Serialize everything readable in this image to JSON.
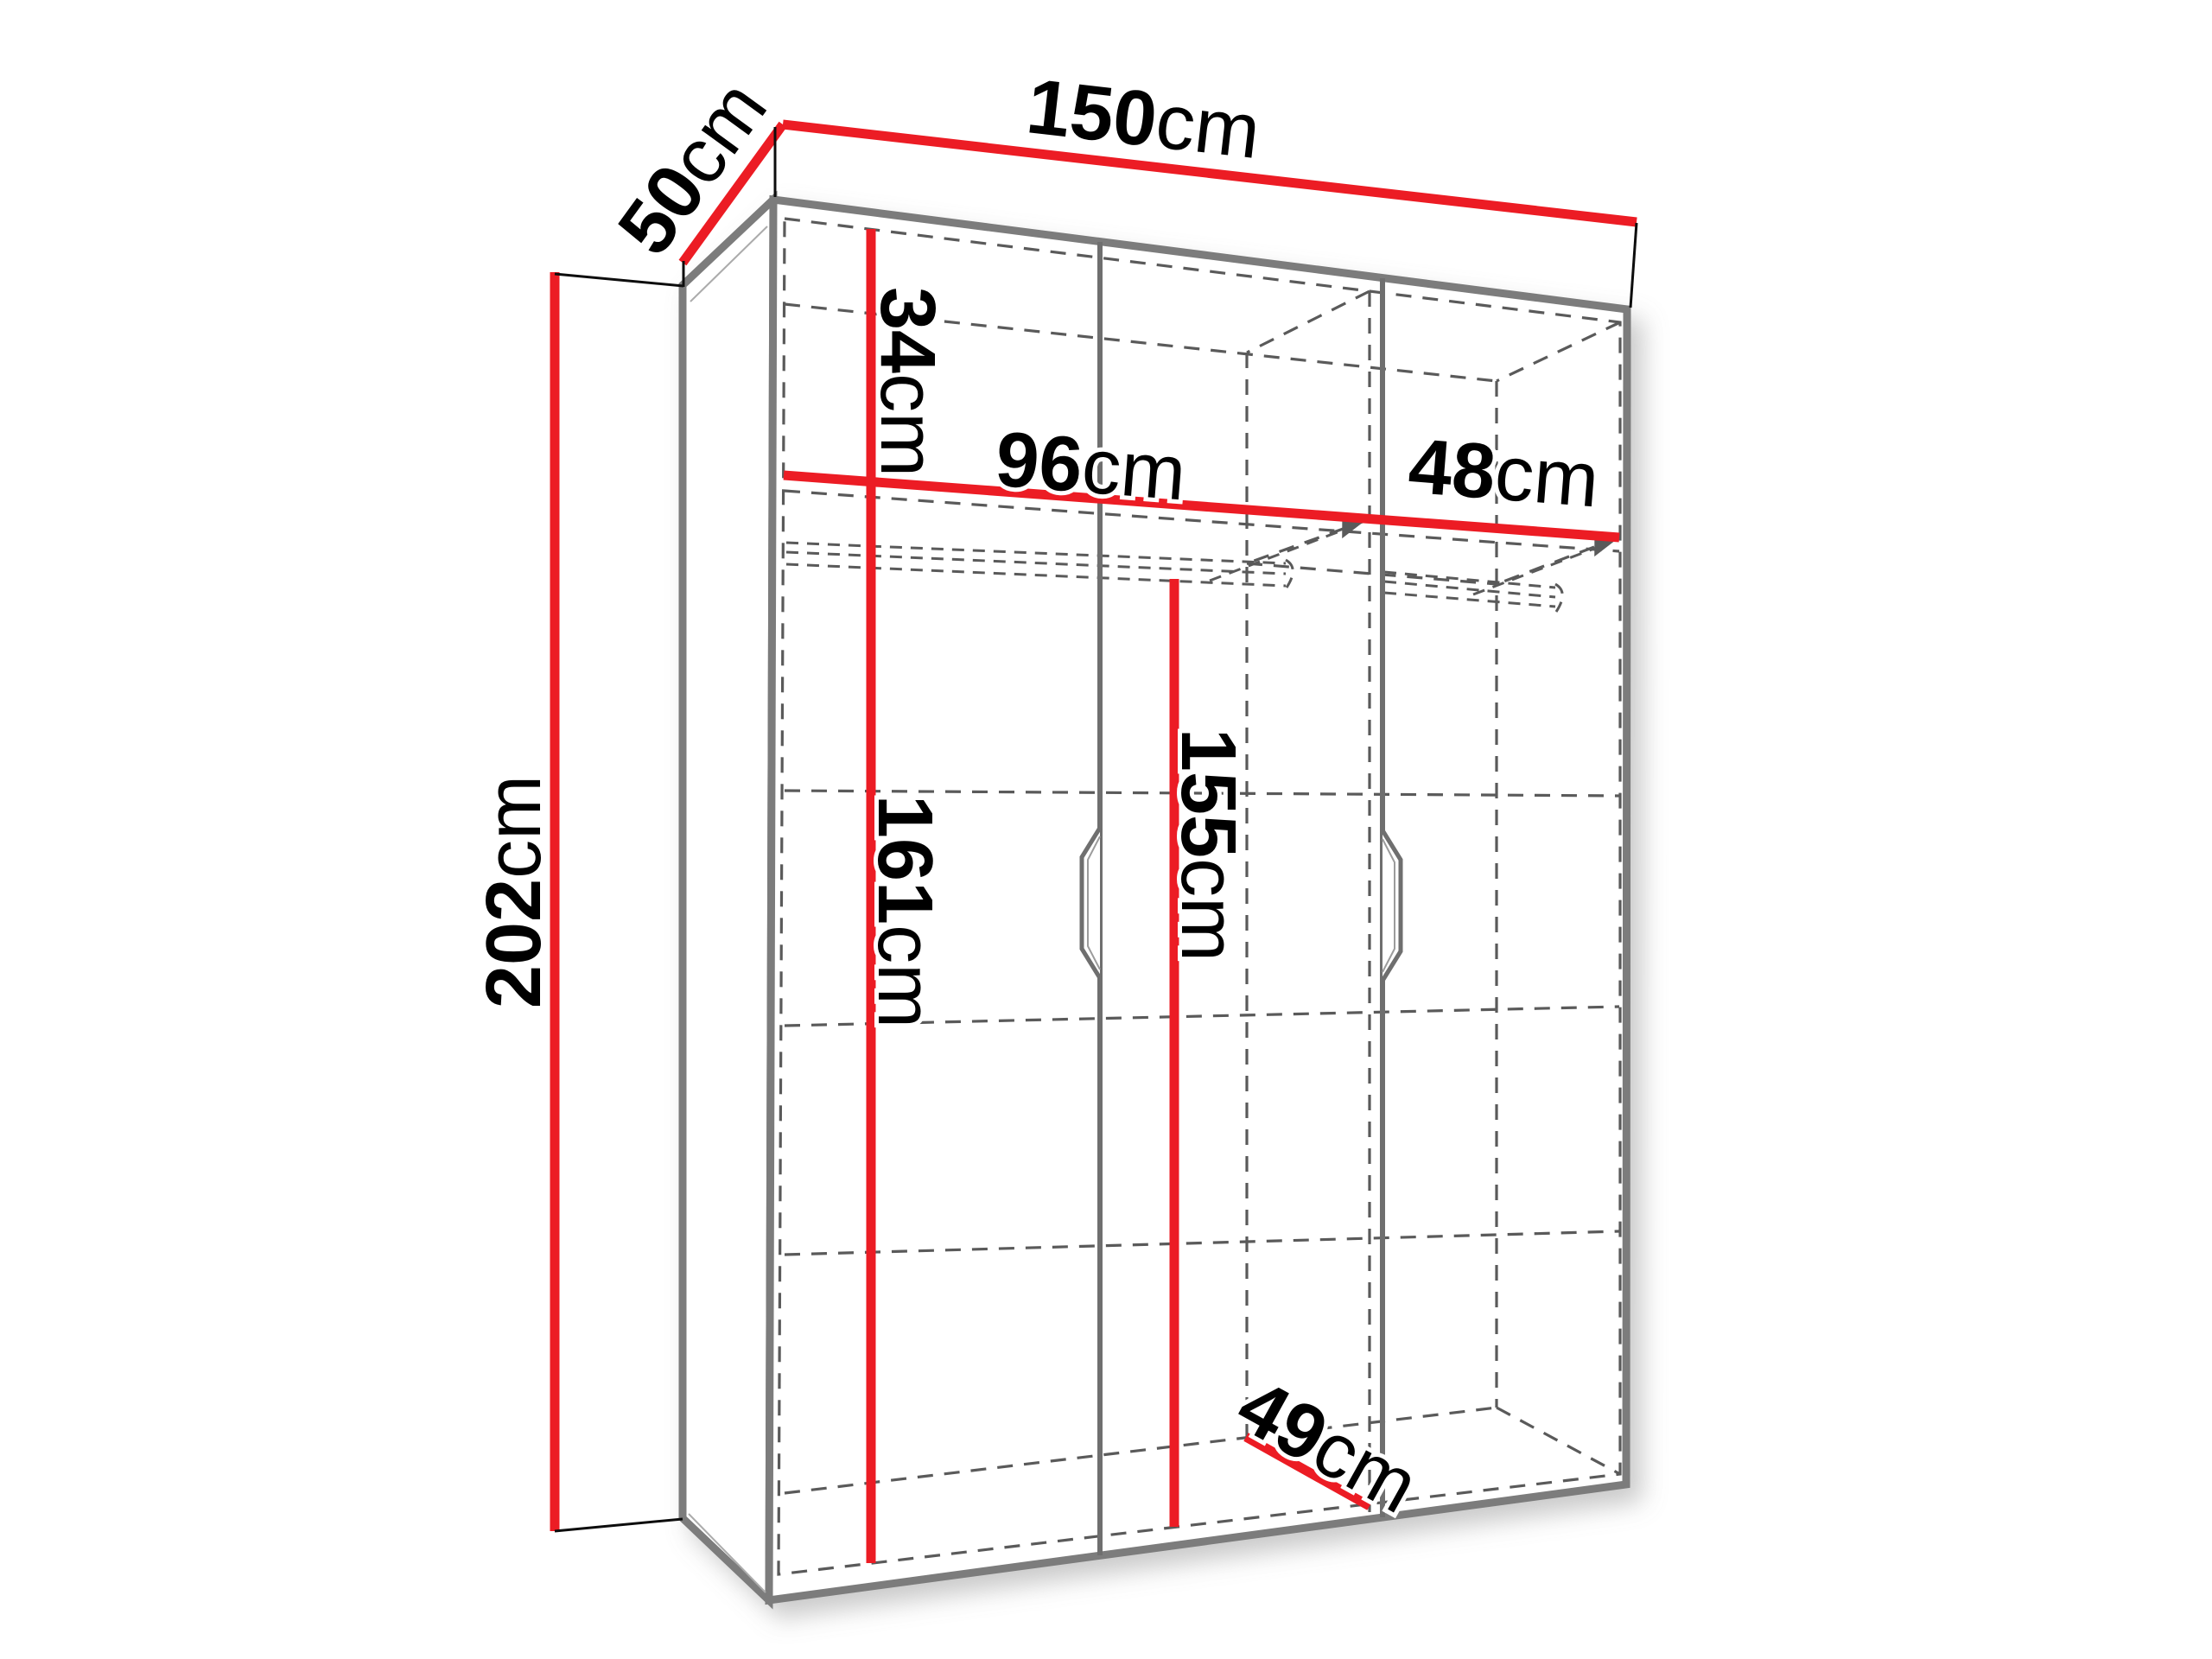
{
  "diagram": {
    "kind": "wardrobe-dimension-diagram",
    "unit": "cm"
  },
  "colors": {
    "dimension_line": "#ec1c24",
    "panel_edge": "#7b7b7b",
    "dashed_line": "#5a5a5a",
    "text": "#000000",
    "background": "#ffffff"
  },
  "labels": {
    "width": {
      "value": "150",
      "unit": "cm"
    },
    "depth": {
      "value": "50",
      "unit": "cm"
    },
    "height": {
      "value": "202",
      "unit": "cm"
    },
    "top_shelf": {
      "value": "34",
      "unit": "cm"
    },
    "left_width": {
      "value": "96",
      "unit": "cm"
    },
    "right_width": {
      "value": "48",
      "unit": "cm"
    },
    "left_height": {
      "value": "161",
      "unit": "cm"
    },
    "rail_height": {
      "value": "155",
      "unit": "cm"
    },
    "inner_depth": {
      "value": "49",
      "unit": "cm"
    }
  }
}
